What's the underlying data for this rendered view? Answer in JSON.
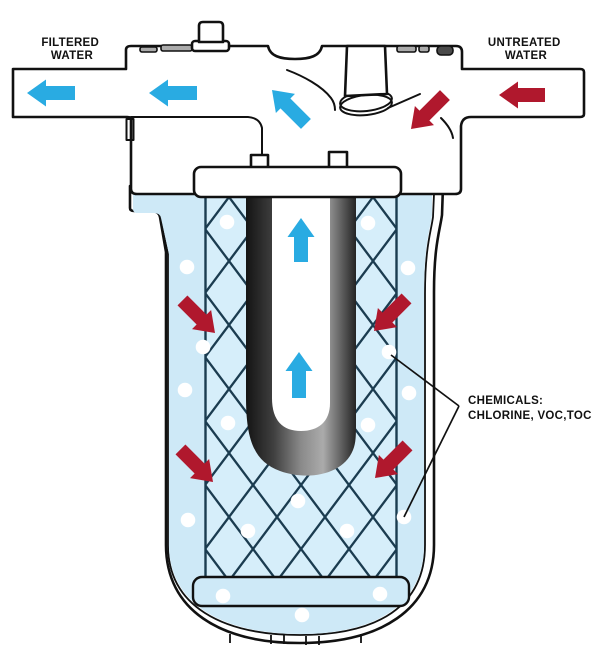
{
  "labels": {
    "filtered": {
      "line1": "FILTERED",
      "line2": "WATER"
    },
    "untreated": {
      "line1": "UNTREATED",
      "line2": "WATER"
    },
    "chemicals": {
      "line1": "CHEMICALS:",
      "line2": "CHLORINE, VOC,TOC"
    }
  },
  "colors": {
    "ink": "#111111",
    "water": "#CEE9F7",
    "water_edge": "#A5D9F0",
    "media_bg": "#D6EEFA",
    "hatch": "#1B3C50",
    "arrow_blue": "#29ABE2",
    "arrow_red": "#B0182D",
    "bubble": "#FFFFFF"
  },
  "flow_arrows": [
    {
      "name": "filtered-out-1",
      "color": "blue",
      "x": 27,
      "y": 93,
      "angle": 0,
      "length": 48
    },
    {
      "name": "filtered-out-2",
      "color": "blue",
      "x": 149,
      "y": 93,
      "angle": 0,
      "length": 48
    },
    {
      "name": "filtered-turn-up",
      "color": "blue",
      "x": 272,
      "y": 90,
      "angle": 45,
      "length": 48
    },
    {
      "name": "riser-up-1",
      "color": "blue",
      "x": 301,
      "y": 218,
      "angle": 90,
      "length": 44
    },
    {
      "name": "riser-up-2",
      "color": "blue",
      "x": 299,
      "y": 352,
      "angle": 90,
      "length": 46
    },
    {
      "name": "untreated-in",
      "color": "red",
      "x": 499,
      "y": 95,
      "angle": 0,
      "length": 46
    },
    {
      "name": "untreated-down",
      "color": "red",
      "x": 411,
      "y": 129,
      "angle": -45,
      "length": 48
    },
    {
      "name": "media-upper-left",
      "color": "red",
      "x": 215,
      "y": 333,
      "angle": -135,
      "length": 46
    },
    {
      "name": "media-upper-right",
      "color": "red",
      "x": 374,
      "y": 331,
      "angle": -45,
      "length": 46
    },
    {
      "name": "media-lower-left",
      "color": "red",
      "x": 213,
      "y": 482,
      "angle": -135,
      "length": 46
    },
    {
      "name": "media-lower-right",
      "color": "red",
      "x": 375,
      "y": 478,
      "angle": -45,
      "length": 46
    }
  ],
  "chemical_bubbles": {
    "radius": 7.3,
    "points": [
      [
        227,
        222
      ],
      [
        368,
        223
      ],
      [
        187,
        267
      ],
      [
        408,
        268
      ],
      [
        203,
        347
      ],
      [
        389,
        352
      ],
      [
        185,
        390
      ],
      [
        409,
        393
      ],
      [
        228,
        423
      ],
      [
        368,
        425
      ],
      [
        298,
        501
      ],
      [
        188,
        520
      ],
      [
        404,
        517
      ],
      [
        248,
        531
      ],
      [
        347,
        531
      ],
      [
        223,
        596
      ],
      [
        380,
        594
      ],
      [
        302,
        615
      ]
    ]
  },
  "leader_lines": [
    [
      459,
      406,
      391,
      355
    ],
    [
      459,
      406,
      404,
      517
    ]
  ]
}
